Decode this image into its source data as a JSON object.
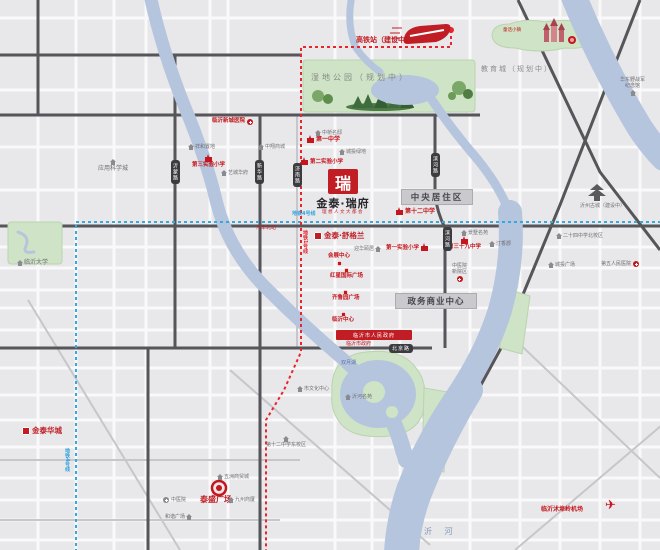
{
  "project": {
    "seal": "瑞",
    "name": "金泰·瑞府",
    "tagline": "理想人文大都会"
  },
  "sister_projects": [
    {
      "name": "金泰·舒格兰"
    },
    {
      "name": "金泰华城"
    },
    {
      "name": "泰盛广场"
    }
  ],
  "transport": {
    "hsr": "高铁站（建设中）",
    "metro_line1": "地铁1号线",
    "metro_line4": "地铁4号线",
    "bus_north": "汽车北站",
    "airport": "临沂沭埠岭机场",
    "river": "沂 河"
  },
  "districts": {
    "central": "中央居住区",
    "gov_business": "政务商业中心",
    "edu_city": "教育城（规划中）",
    "wetland": "湿地公园（规划中）",
    "castle_town": "童话小镇",
    "ancient_city": "沂州古城（建设中）",
    "lake": "双月湖"
  },
  "schools": [
    {
      "name": "第一中学"
    },
    {
      "name": "第二实验小学"
    },
    {
      "name": "第三实验小学"
    },
    {
      "name": "第十二中学"
    },
    {
      "name": "第一实验小学"
    },
    {
      "name": "第三十九中学"
    },
    {
      "name": "二十四中学北校区"
    },
    {
      "name": "第十二中学东校区"
    },
    {
      "name": "临沂大学"
    },
    {
      "name": "应用科学城"
    }
  ],
  "hospitals": [
    {
      "name": "临沂新城医院"
    },
    {
      "name": "第五人民医院"
    },
    {
      "name": "中医院",
      "line2": "新院区"
    },
    {
      "name": "中医院"
    }
  ],
  "commercial": [
    {
      "name": "会展中心"
    },
    {
      "name": "红星国际广场"
    },
    {
      "name": "齐鲁园广场"
    },
    {
      "name": "临沂中心"
    },
    {
      "name": "和谐广场"
    },
    {
      "name": "九州商厦"
    },
    {
      "name": "五洲商贸城"
    }
  ],
  "residential": [
    {
      "name": "祥和置地"
    },
    {
      "name": "中翔商城"
    },
    {
      "name": "艺城华府"
    },
    {
      "name": "中桥名邸"
    },
    {
      "name": "城投绿地"
    },
    {
      "name": "迎华颐居"
    },
    {
      "name": "景墅名苑"
    },
    {
      "name": "汀香郡"
    },
    {
      "name": "城投广场"
    },
    {
      "name": "沂河名苑"
    },
    {
      "name": "市文化中心"
    }
  ],
  "landmarks": {
    "memorial_l1": "华东野战军",
    "memorial_l2": "纪念馆",
    "government": "临沂市人民政府",
    "government_sub": "临沂市政府"
  },
  "roads": [
    "沂蒙路",
    "新华路",
    "济南路",
    "滨河路",
    "滨河路",
    "北京路"
  ],
  "icons": {
    "plane": "✈"
  },
  "colors": {
    "brand_red": "#c01d24",
    "metro_blue": "#35a8dd",
    "river": "#b6c5de",
    "park": "#cfe3c6"
  }
}
